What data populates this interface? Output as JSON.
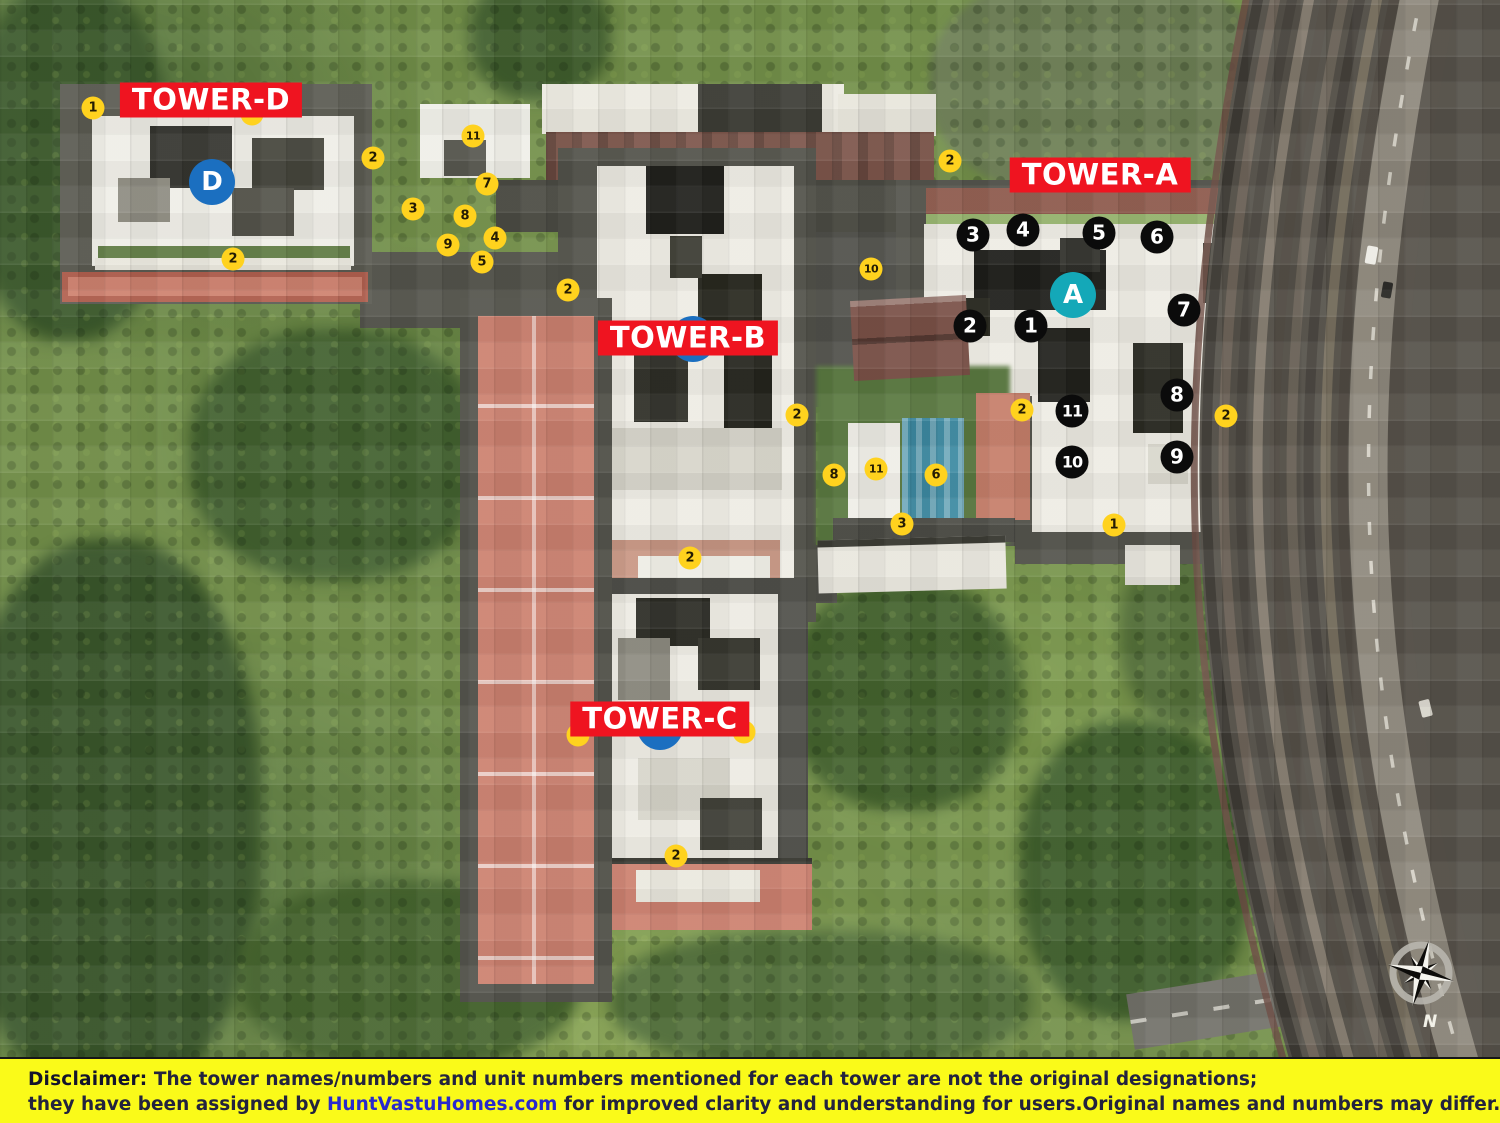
{
  "map": {
    "towers": [
      {
        "name": "TOWER-D",
        "letter": "D",
        "label_x": 211,
        "label_y": 100,
        "letter_x": 212,
        "letter_y": 182,
        "letter_color": "#1B6FC0",
        "letter_behind": false
      },
      {
        "name": "TOWER-A",
        "letter": "A",
        "label_x": 1100,
        "label_y": 175,
        "letter_x": 1073,
        "letter_y": 295,
        "letter_color": "#14A8B8",
        "letter_behind": false
      },
      {
        "name": "TOWER-B",
        "letter": "B",
        "label_x": 688,
        "label_y": 338,
        "letter_x": 693,
        "letter_y": 339,
        "letter_color": "#1B6FC0",
        "letter_behind": true
      },
      {
        "name": "TOWER-C",
        "letter": "C",
        "label_x": 660,
        "label_y": 719,
        "letter_x": 660,
        "letter_y": 727,
        "letter_color": "#1B6FC0",
        "letter_behind": true
      }
    ],
    "yellow_markers": [
      {
        "n": "1",
        "x": 93,
        "y": 108
      },
      {
        "n": "",
        "x": 252,
        "y": 114,
        "behind": true
      },
      {
        "n": "2",
        "x": 373,
        "y": 158
      },
      {
        "n": "11",
        "x": 473,
        "y": 136
      },
      {
        "n": "7",
        "x": 487,
        "y": 184
      },
      {
        "n": "3",
        "x": 413,
        "y": 209
      },
      {
        "n": "8",
        "x": 465,
        "y": 216
      },
      {
        "n": "9",
        "x": 448,
        "y": 245
      },
      {
        "n": "4",
        "x": 495,
        "y": 238
      },
      {
        "n": "5",
        "x": 482,
        "y": 262
      },
      {
        "n": "2",
        "x": 233,
        "y": 259
      },
      {
        "n": "2",
        "x": 568,
        "y": 290
      },
      {
        "n": "10",
        "x": 871,
        "y": 269
      },
      {
        "n": "2",
        "x": 950,
        "y": 161
      },
      {
        "n": "2",
        "x": 797,
        "y": 415
      },
      {
        "n": "8",
        "x": 834,
        "y": 475
      },
      {
        "n": "11",
        "x": 876,
        "y": 469
      },
      {
        "n": "6",
        "x": 936,
        "y": 475
      },
      {
        "n": "3",
        "x": 902,
        "y": 524
      },
      {
        "n": "2",
        "x": 690,
        "y": 558
      },
      {
        "n": "2",
        "x": 1022,
        "y": 410
      },
      {
        "n": "2",
        "x": 1226,
        "y": 416
      },
      {
        "n": "1",
        "x": 1114,
        "y": 525
      },
      {
        "n": "",
        "x": 578,
        "y": 735,
        "behind": true
      },
      {
        "n": "",
        "x": 744,
        "y": 732,
        "behind": true
      },
      {
        "n": "2",
        "x": 676,
        "y": 856
      }
    ],
    "black_markers": [
      {
        "n": "3",
        "x": 973,
        "y": 235
      },
      {
        "n": "4",
        "x": 1023,
        "y": 230
      },
      {
        "n": "5",
        "x": 1099,
        "y": 233
      },
      {
        "n": "6",
        "x": 1157,
        "y": 237
      },
      {
        "n": "2",
        "x": 970,
        "y": 326
      },
      {
        "n": "1",
        "x": 1031,
        "y": 326
      },
      {
        "n": "7",
        "x": 1184,
        "y": 310
      },
      {
        "n": "8",
        "x": 1177,
        "y": 395
      },
      {
        "n": "11",
        "x": 1072,
        "y": 411
      },
      {
        "n": "10",
        "x": 1072,
        "y": 462
      },
      {
        "n": "9",
        "x": 1177,
        "y": 457
      }
    ],
    "compass": {
      "label": "N"
    }
  },
  "disclaimer": {
    "prefix": "Disclaimer:",
    "line1_rest": " The tower names/numbers and unit numbers mentioned for each tower are not the original designations;",
    "line2_a": "they have been assigned by ",
    "link": "HuntVastuHomes.com",
    "line2_b": " for improved clarity and understanding for users.Original names and numbers may differ."
  },
  "colors": {
    "tower_label_bg": "#EF1420",
    "tower_label_text": "#FFFFFF",
    "yellow_marker": "#FFD21E",
    "black_marker": "#0B0B0B",
    "letter_blue": "#1B6FC0",
    "letter_teal": "#14A8B8",
    "disclaimer_bg": "#FAFA19",
    "disclaimer_text": "#23233E",
    "disclaimer_link": "#2929CC"
  }
}
